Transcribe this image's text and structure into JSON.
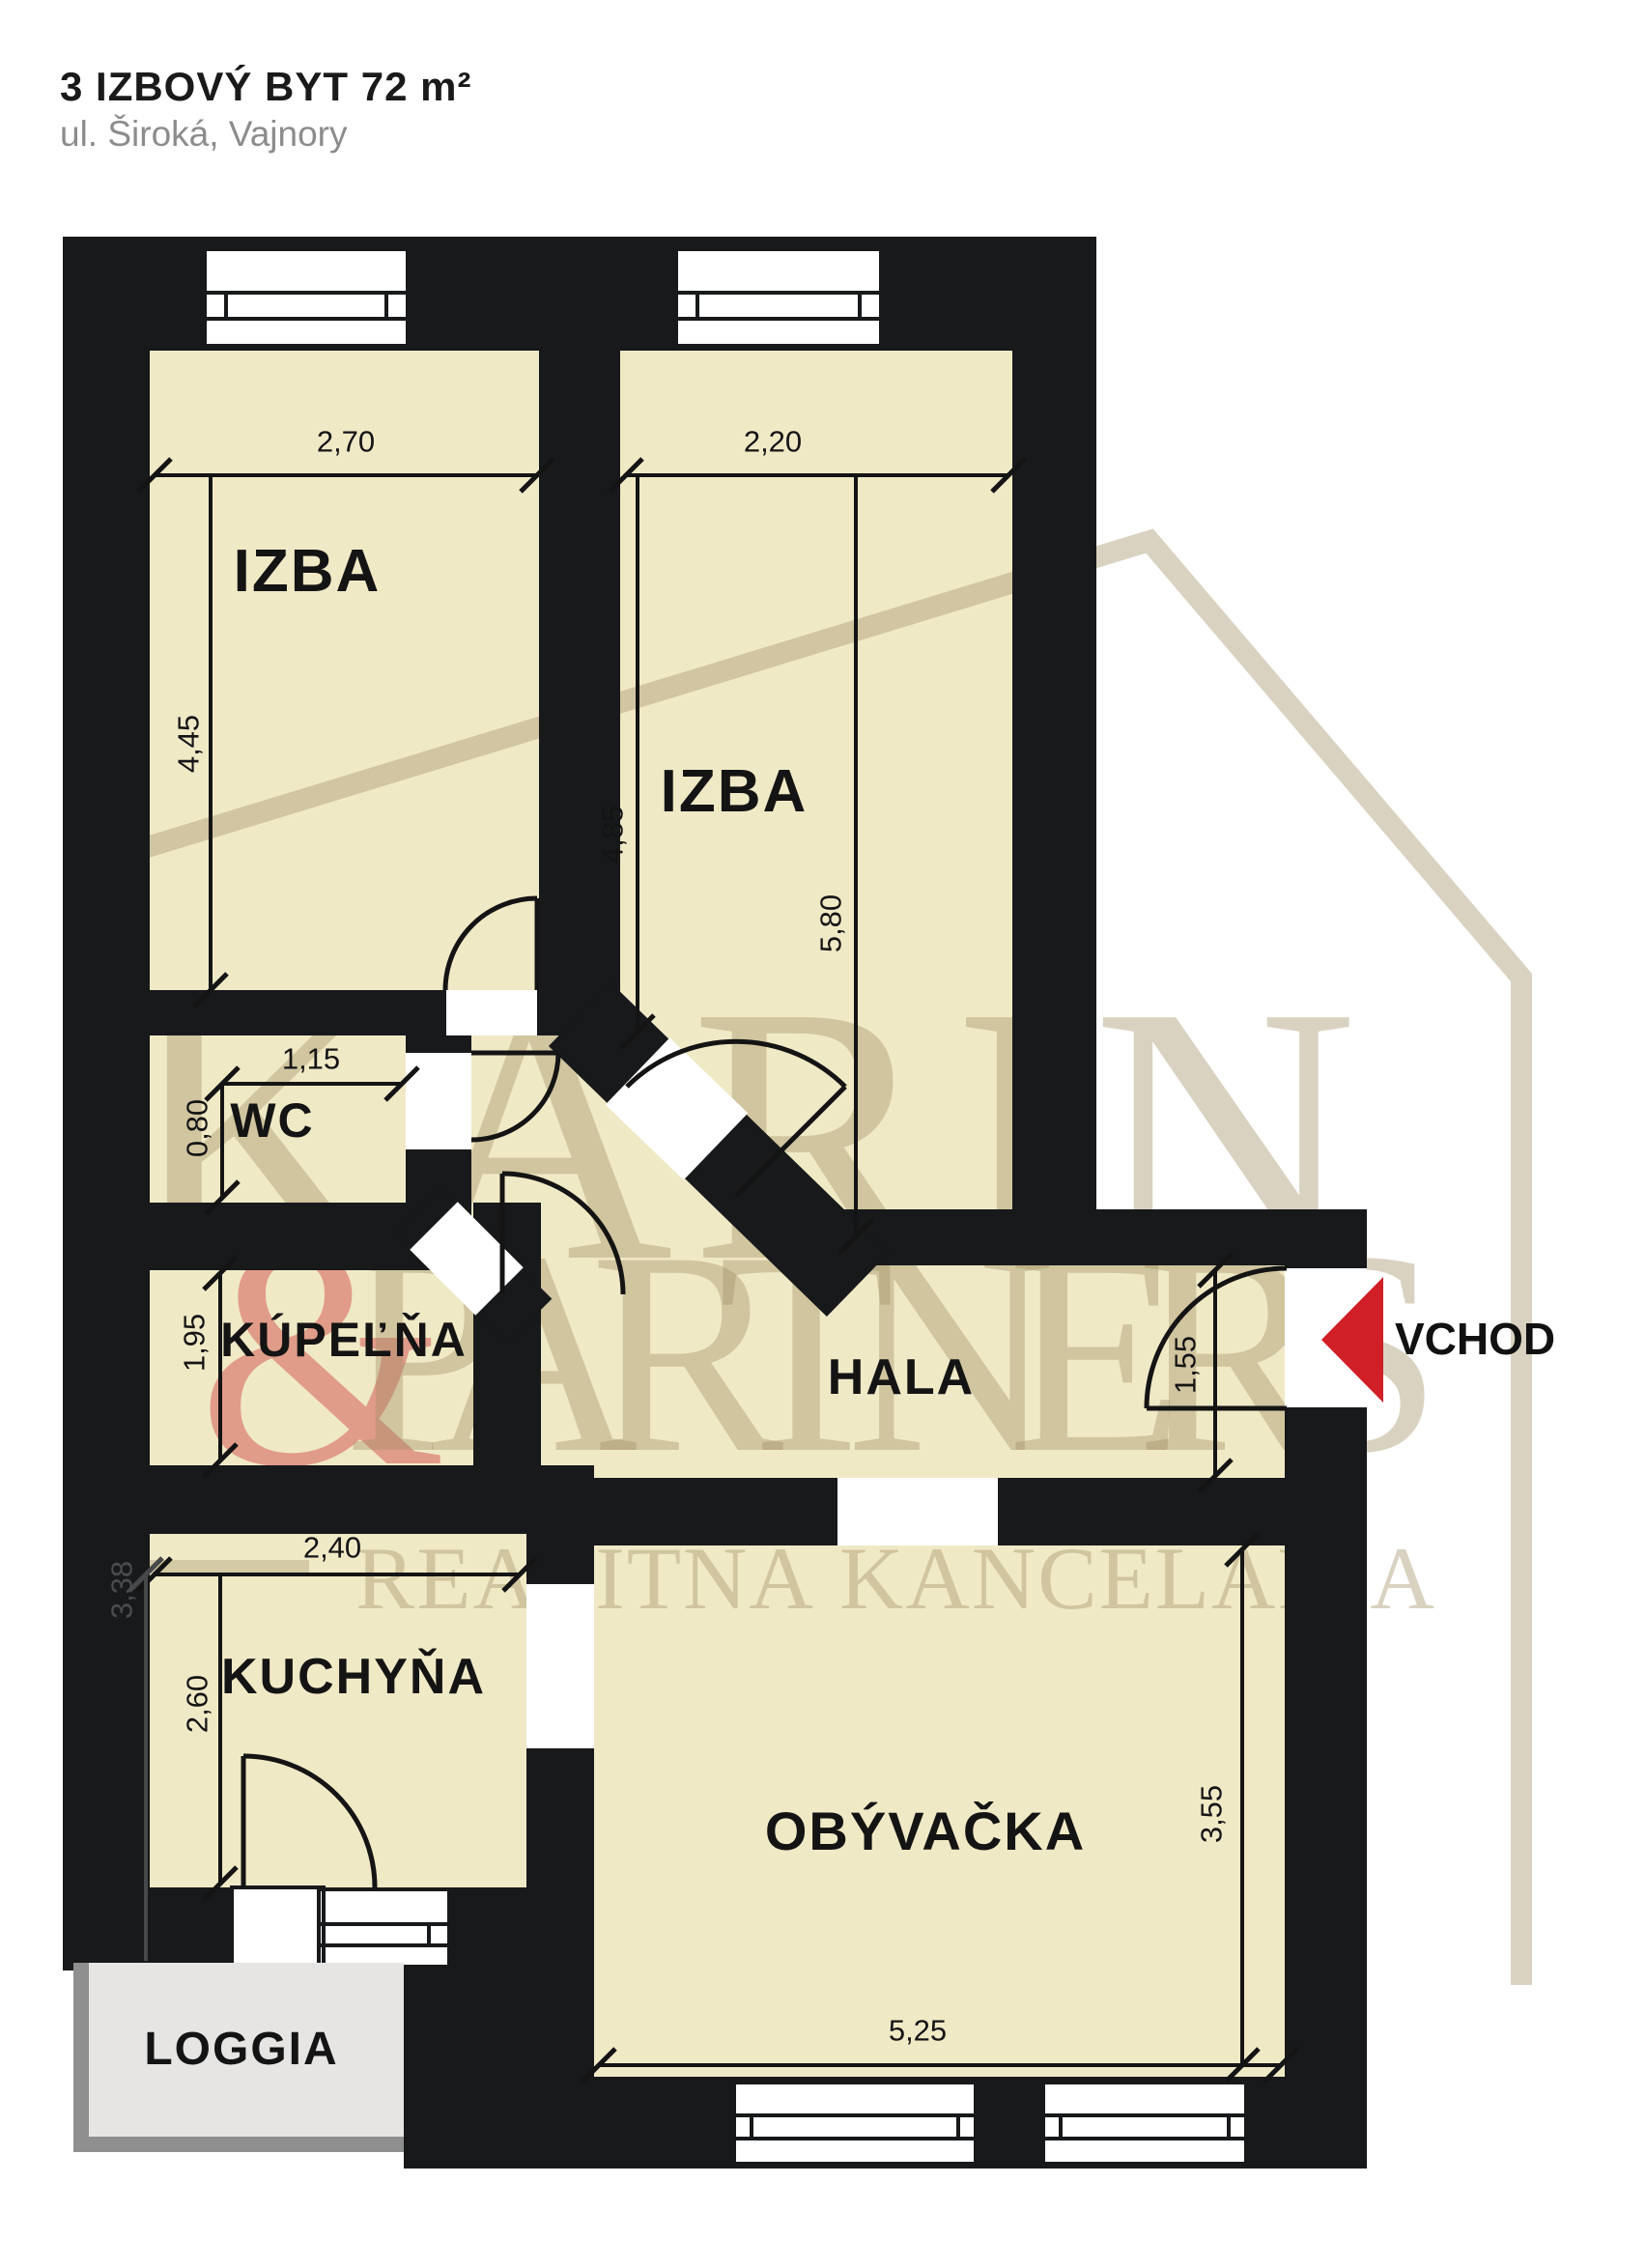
{
  "header": {
    "title": "3 IZBOVÝ BYT  72 m²",
    "subtitle": "ul. Široká, Vajnory"
  },
  "rooms": {
    "izba1": "IZBA",
    "izba2": "IZBA",
    "wc": "WC",
    "kupelna": "KÚPEĽŇA",
    "hala": "HALA",
    "kuchyna": "KUCHYŇA",
    "obyvacka": "OBÝVAČKA",
    "loggia": "LOGGIA"
  },
  "entrance": {
    "label": "VCHOD"
  },
  "dimensions": {
    "izba1_width": "2,70",
    "izba1_height": "4,45",
    "izba2_width": "2,20",
    "izba2_height_inner": "4,85",
    "izba2_height_full": "5,80",
    "wc_width": "1,15",
    "wc_height": "0,80",
    "kupelna_height": "1,95",
    "kuchyna_width": "2,40",
    "kuchyna_height": "2,60",
    "left_wall_height": "3,38",
    "hala_height": "1,55",
    "obyvacka_height": "3,55",
    "obyvacka_width": "5,25"
  },
  "watermark": {
    "line1": "KARIN",
    "ampersand": "&",
    "line2": "PARTNERS",
    "line3": "REALITNÁ KANCELÁRIA",
    "copyright": "©"
  },
  "colors": {
    "wall": "#17191b",
    "floor": "#f0e9c6",
    "loggia_fill": "#e6e5e3",
    "loggia_shadow": "#8f8f8f",
    "accent_red": "#d01f27",
    "title_gray": "#8c8c8c",
    "watermark_beige": "#a08f64",
    "watermark_red": "#d2504b",
    "dim_line": "#141414"
  }
}
